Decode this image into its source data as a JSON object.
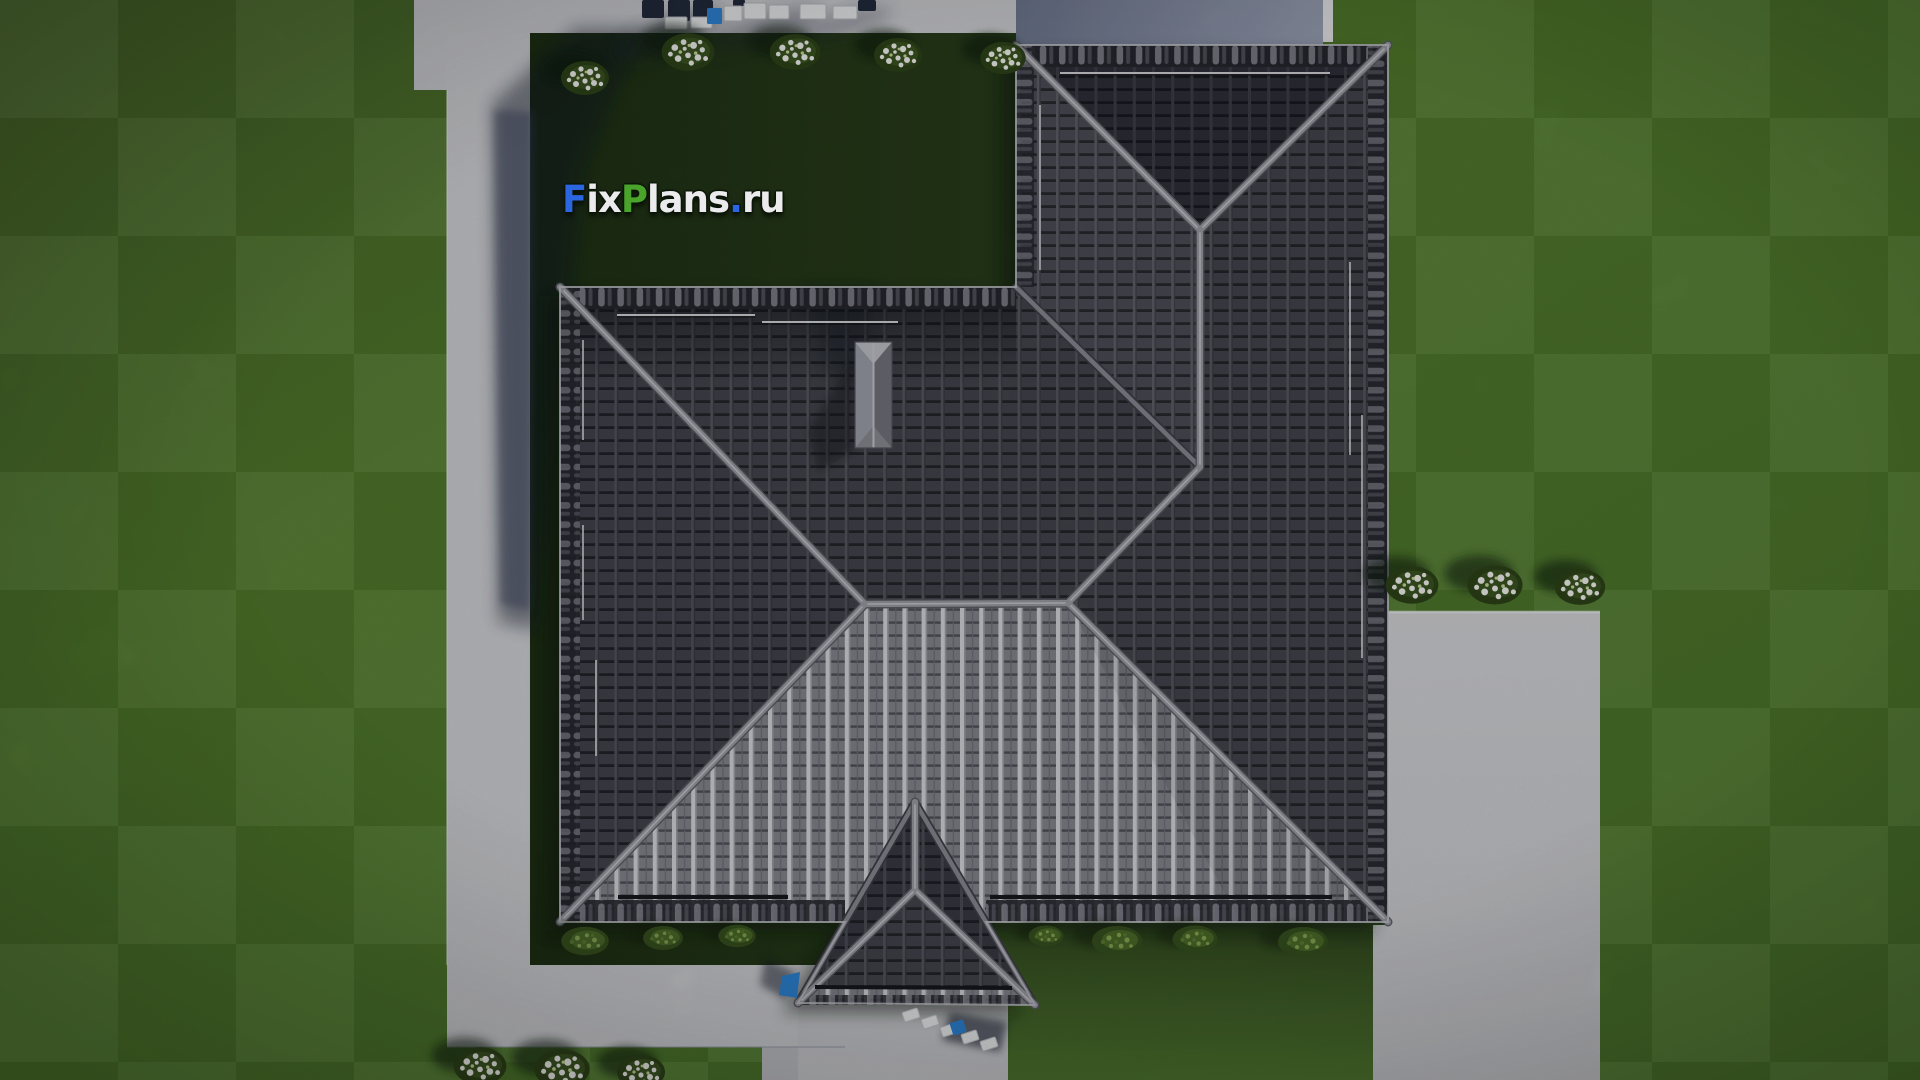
{
  "meta": {
    "description": "Aerial top-down 3D architectural rendering of a house with a dark hip tile roof on a landscaped lawn plot",
    "view": "top-down aerial",
    "image_kind": "3d-render"
  },
  "watermark": {
    "text": "FixPlans.ru",
    "segments": [
      {
        "text": "F",
        "color": "#2b66e0"
      },
      {
        "text": "ix",
        "color": "#ebebee"
      },
      {
        "text": "P",
        "color": "#4aa32b"
      },
      {
        "text": "lans",
        "color": "#ebebee"
      },
      {
        "text": ".",
        "color": "#2b66e0"
      },
      {
        "text": "ru",
        "color": "#ebebee"
      }
    ]
  },
  "palette": {
    "lawn_bright": "#54802f",
    "lawn_plot_dark": "#293f1c",
    "lawn_medium": "#4f7530",
    "concrete": "#d0d1d5",
    "concrete_shaded": "#7c849c",
    "terrace_band": "#8a93a9",
    "roof_dark": "#45464e",
    "roof_mid": "#4d4e57",
    "roof_bright": "#85868e",
    "roof_rib_bright": "#d7d7dc",
    "ridge_cap": "#9c9da5",
    "chimney": "#a9aab3",
    "flower_white": "#f2f3ef",
    "bush_dark_green": "#2e4419",
    "shrub_light_green": "#86a653",
    "furniture_navy": "#232c3e",
    "furniture_blue": "#2f86d8",
    "furniture_white": "#eceef0",
    "shadow_blue": "#0d1626"
  },
  "scene": {
    "house": {
      "roof_style": "hip roof, dark grey tiles",
      "sections": [
        "main hip roof",
        "upper-right wing with vertical ridge",
        "front porch gable at bottom",
        "chimney on north slope"
      ],
      "chimney_count": 1
    },
    "landscape": {
      "flowering_bushes_top_row": 5,
      "flowering_bushes_right_of_house": 3,
      "flowering_bushes_bottom_left": 3,
      "green_shrubs_under_eaves": 7,
      "paths": [
        "left walkway",
        "top terrace pad",
        "bottom walkway to porch",
        "right driveway patio"
      ],
      "furniture": [
        "outdoor seating set at top edge",
        "white bench with blue cushion at bottom walkway",
        "blue mat beside porch"
      ]
    }
  }
}
